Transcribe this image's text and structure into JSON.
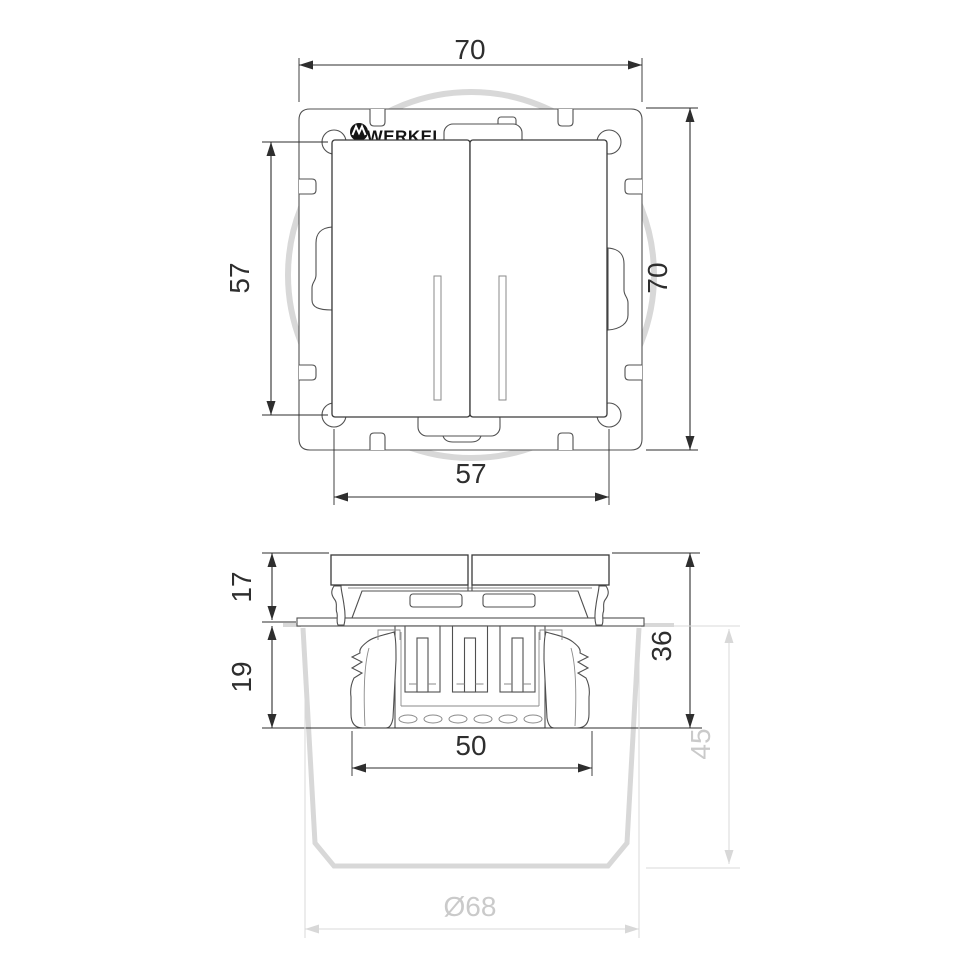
{
  "brand": {
    "logo_text": "WERKEL"
  },
  "front_view": {
    "dims": {
      "overall_width_top": "70",
      "overall_height_right": "70",
      "rocker_height_left": "57",
      "screw_spacing_bottom": "57"
    }
  },
  "side_view": {
    "dims": {
      "front_protrusion": "17",
      "recess_upper": "19",
      "total_depth": "36",
      "box_depth_ghost": "45",
      "claw_span": "50",
      "box_diameter_ghost": "Ø68"
    }
  },
  "colors": {
    "line": "#505050",
    "line-dark": "#3a3a3a",
    "line-thin": "#8a8a8a",
    "dim": "#2e2e2e",
    "ghost": "#d8d8d8",
    "ghost-text": "#cacaca",
    "logo": "#141414",
    "background": "#ffffff"
  }
}
